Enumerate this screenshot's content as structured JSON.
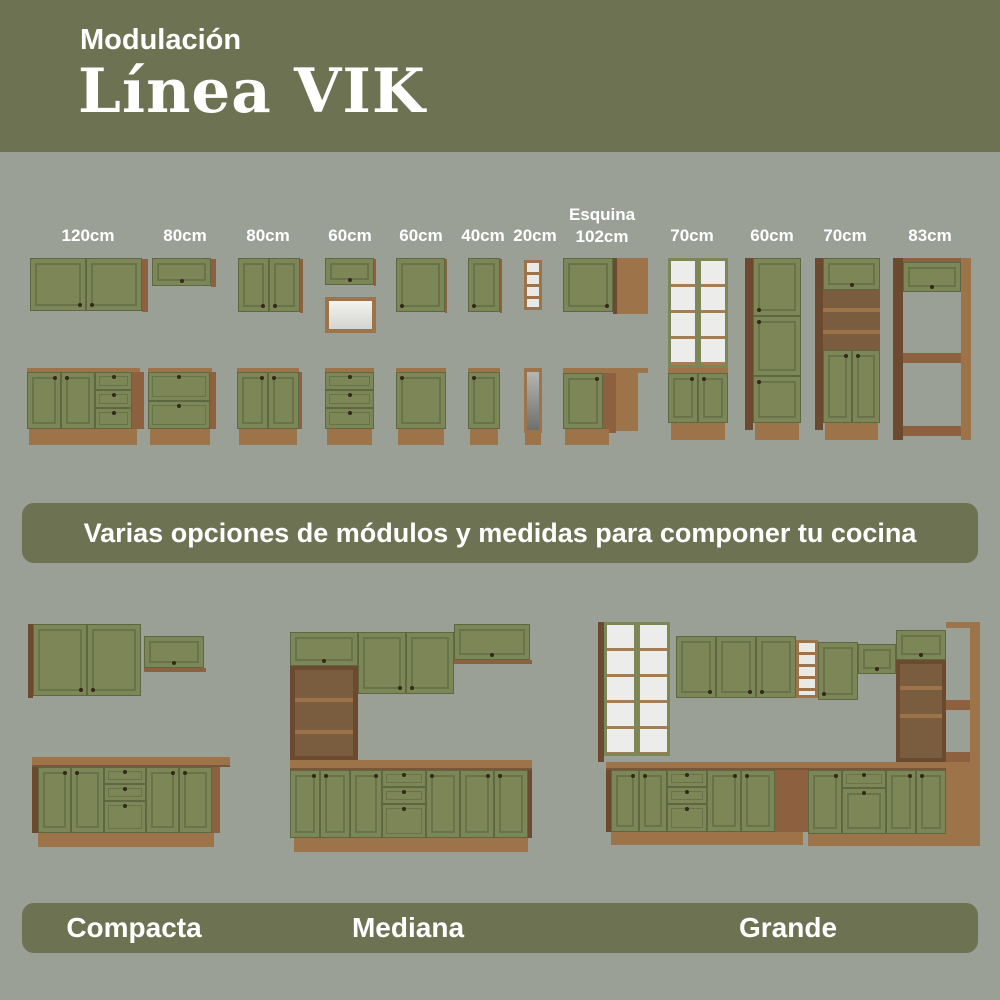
{
  "header": {
    "kicker": "Modulación",
    "title": "Línea VIK"
  },
  "colors": {
    "olive_banner": "#6d7352",
    "background": "#9aa096",
    "cabinet_green": "#7d8657",
    "wood_brown": "#8d6140",
    "wood_light": "#9d7349",
    "text": "#ffffff"
  },
  "modules": {
    "banner_text": "Varias opciones de módulos y medidas para componer tu cocina",
    "labels": [
      {
        "label": "120cm"
      },
      {
        "label": "80cm"
      },
      {
        "label": "80cm"
      },
      {
        "label": "60cm"
      },
      {
        "label": "60cm"
      },
      {
        "label": "40cm"
      },
      {
        "label": "20cm"
      },
      {
        "line1": "Esquina",
        "line2": "102cm"
      },
      {
        "label": "70cm"
      },
      {
        "label": "60cm"
      },
      {
        "label": "70cm"
      },
      {
        "label": "83cm"
      }
    ]
  },
  "kitchens": {
    "labels": [
      "Compacta",
      "Mediana",
      "Grande"
    ]
  }
}
